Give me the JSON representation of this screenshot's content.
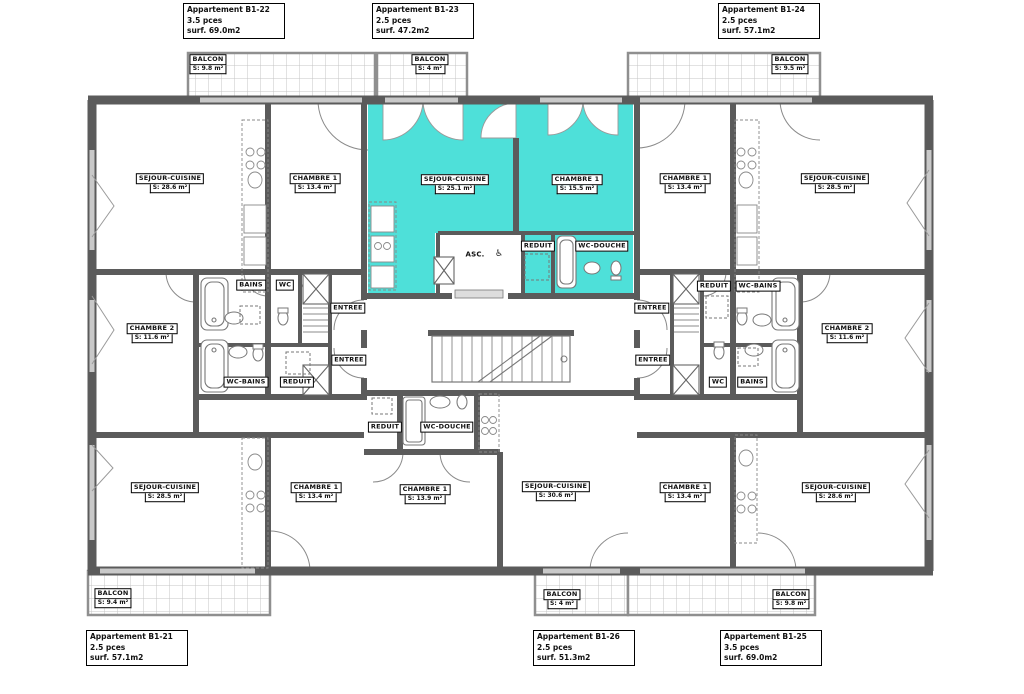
{
  "document": {
    "kind": "architectural-floor-plan"
  },
  "colors": {
    "highlight": "#4EE0D9",
    "wall": "#5b5b5b",
    "hatch": "#bdbdbd"
  },
  "apartments": [
    {
      "id": "B1-22",
      "title": "Appartement B1-22",
      "pieces": "3.5 pces",
      "surface": "surf. 69.0m2",
      "highlighted": false
    },
    {
      "id": "B1-23",
      "title": "Appartement B1-23",
      "pieces": "2.5 pces",
      "surface": "surf. 47.2m2",
      "highlighted": true
    },
    {
      "id": "B1-24",
      "title": "Appartement B1-24",
      "pieces": "2.5 pces",
      "surface": "surf. 57.1m2",
      "highlighted": false
    },
    {
      "id": "B1-21",
      "title": "Appartement B1-21",
      "pieces": "2.5 pces",
      "surface": "surf. 57.1m2",
      "highlighted": false
    },
    {
      "id": "B1-26",
      "title": "Appartement B1-26",
      "pieces": "2.5 pces",
      "surface": "surf. 51.3m2",
      "highlighted": false
    },
    {
      "id": "B1-25",
      "title": "Appartement B1-25",
      "pieces": "3.5 pces",
      "surface": "surf. 69.0m2",
      "highlighted": false
    }
  ],
  "rooms": [
    {
      "name": "BALCON",
      "area": "S: 9.8 m²"
    },
    {
      "name": "BALCON",
      "area": "S: 4 m²"
    },
    {
      "name": "BALCON",
      "area": "S: 9.5 m²"
    },
    {
      "name": "SEJOUR-CUISINE",
      "area": "S: 28.6 m²"
    },
    {
      "name": "CHAMBRE 1",
      "area": "S: 13.4 m²"
    },
    {
      "name": "SEJOUR-CUISINE",
      "area": "S: 25.1 m²"
    },
    {
      "name": "CHAMBRE 1",
      "area": "S: 15.5 m²"
    },
    {
      "name": "CHAMBRE 1",
      "area": "S: 13.4 m²"
    },
    {
      "name": "SEJOUR-CUISINE",
      "area": "S: 28.5 m²"
    },
    {
      "name": "CHAMBRE 2",
      "area": "S: 11.6 m²"
    },
    {
      "name": "CHAMBRE 2",
      "area": "S: 11.6 m²"
    },
    {
      "name": "SEJOUR-CUISINE",
      "area": "S: 28.5 m²"
    },
    {
      "name": "CHAMBRE 1",
      "area": "S: 13.4 m²"
    },
    {
      "name": "CHAMBRE 1",
      "area": "S: 13.9 m²"
    },
    {
      "name": "SEJOUR-CUISINE",
      "area": "S: 30.6 m²"
    },
    {
      "name": "CHAMBRE 1",
      "area": "S: 13.4 m²"
    },
    {
      "name": "SEJOUR-CUISINE",
      "area": "S: 28.6 m²"
    },
    {
      "name": "BALCON",
      "area": "S: 9.4 m²"
    },
    {
      "name": "BALCON",
      "area": "S: 4 m²"
    },
    {
      "name": "BALCON",
      "area": "S: 9.8 m²"
    }
  ],
  "service_labels": [
    "BAINS",
    "WC",
    "ENTREE",
    "ENTREE",
    "WC-BAINS",
    "REDUIT",
    "REDUIT",
    "WC-DOUCHE",
    "ENTREE",
    "ENTREE",
    "REDUIT",
    "WC-BAINS",
    "WC",
    "BAINS",
    "REDUIT",
    "WC-DOUCHE"
  ],
  "elevator": {
    "label": "ASC.",
    "icon_glyph": "♿"
  }
}
